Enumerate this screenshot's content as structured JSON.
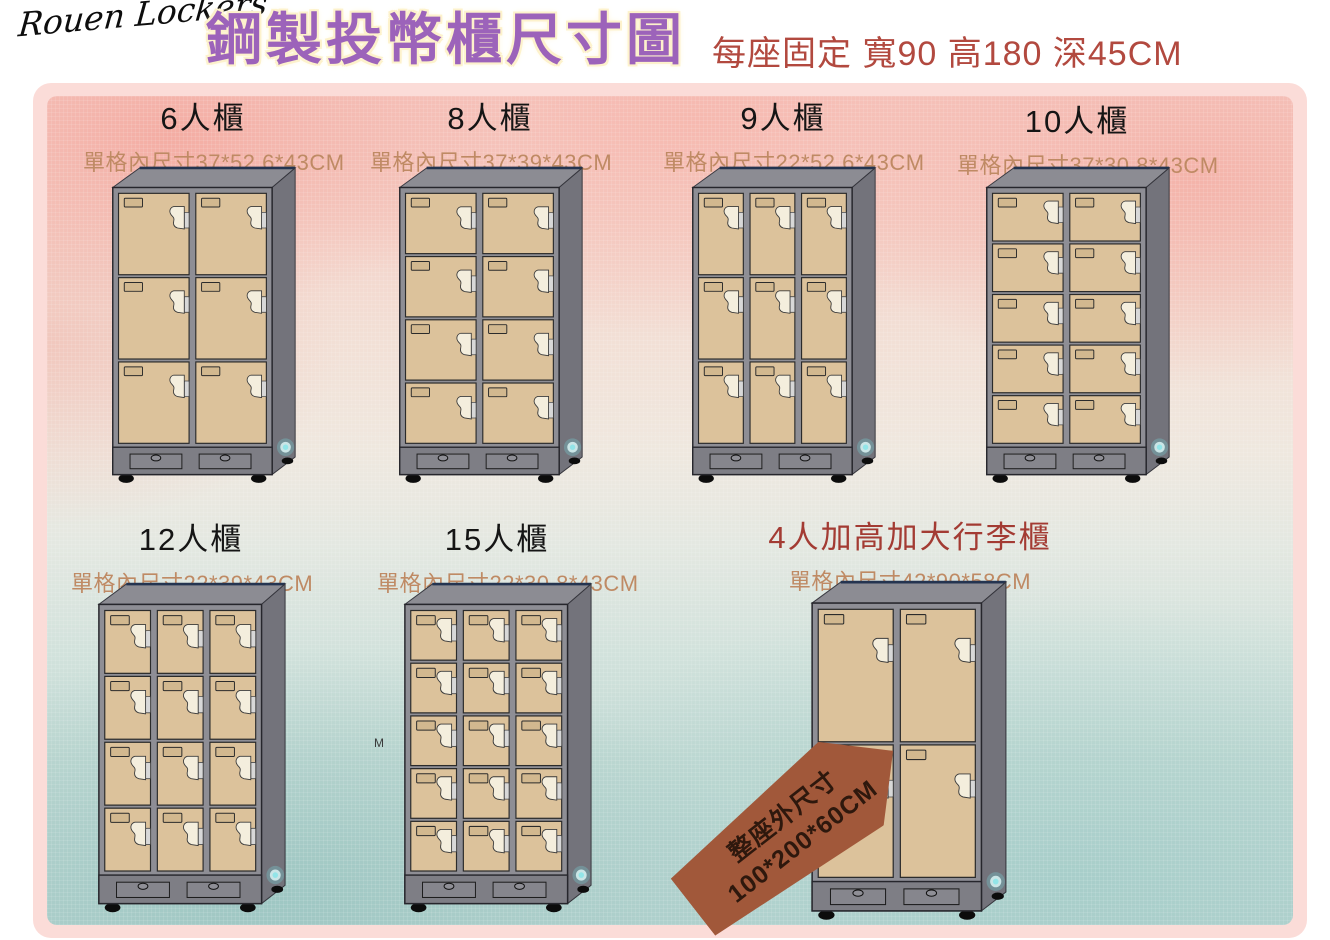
{
  "header": {
    "brand": "Rouen Lockers",
    "title": "鋼製投幣櫃尺寸圖",
    "subtitle": "每座固定 寬90 高180 深45CM"
  },
  "lockers": [
    {
      "name": "6人櫃",
      "dims": "單格內尺寸37*52.6*43CM",
      "cols": 2,
      "rows": 3,
      "highlight": false
    },
    {
      "name": "8人櫃",
      "dims": "單格內尺寸37*39*43CM",
      "cols": 2,
      "rows": 4,
      "highlight": false
    },
    {
      "name": "9人櫃",
      "dims": "單格內尺寸22*52.6*43CM",
      "cols": 3,
      "rows": 3,
      "highlight": false
    },
    {
      "name": "10人櫃",
      "dims": "單格內尺寸37*30.8*43CM",
      "cols": 2,
      "rows": 5,
      "highlight": false
    },
    {
      "name": "12人櫃",
      "dims": "單格內尺寸22*39*43CM",
      "cols": 3,
      "rows": 4,
      "highlight": false
    },
    {
      "name": "15人櫃",
      "dims": "單格內尺寸22*30.8*43CM",
      "cols": 3,
      "rows": 5,
      "highlight": false
    },
    {
      "name": "4人加高加大行李櫃",
      "dims": "單格內尺寸42*90*58CM",
      "cols": 2,
      "rows": 2,
      "highlight": true
    }
  ],
  "luggage_tag": {
    "line1": "整座外尺寸",
    "line2": "100*200*60CM"
  },
  "stray_mark": "M",
  "colors": {
    "title_purple": "#9c63ba",
    "title_halo": "#fdf2cc",
    "subtitle_red": "#b2493f",
    "name_black": "#151515",
    "dims_tan": "#bf8a64",
    "highlight_red": "#a33b33",
    "tag_brown": "#a1583a",
    "tag_text": "#2e180d",
    "mat_pink": "#fbdcd8",
    "cabinet_top": "#8c8c93",
    "cabinet_side": "#73737b",
    "cabinet_front": "#8e8e95",
    "plinth": "#7e7e85",
    "drawer": "#86868d",
    "door": "#dcc29b",
    "door_label": "#d2b88f",
    "handle_cream": "#f4eedd",
    "badge_cyan": "#78d8dc"
  }
}
